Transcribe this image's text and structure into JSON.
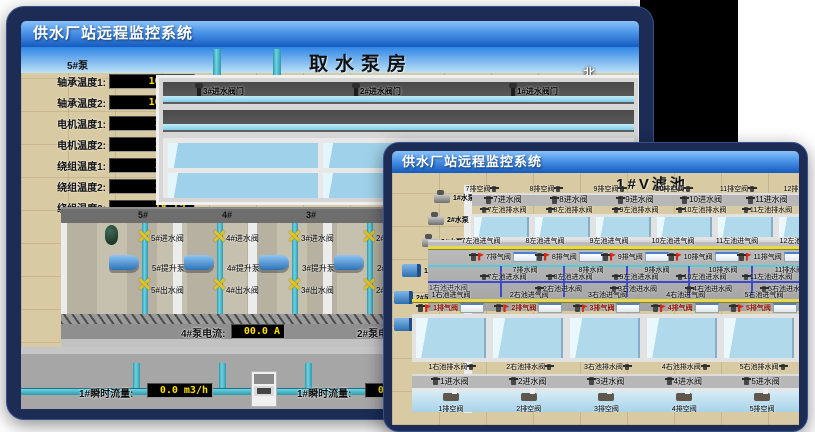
{
  "page": {
    "background": "#ffffff"
  },
  "colors": {
    "window_frame": "#1c2c55",
    "titlebar_top": "#8ac2f9",
    "titlebar_bottom": "#155abe",
    "title_text": "#ffffff",
    "floor_tan": "#d8caa2",
    "sky_blue": "#2f86e6",
    "pool_water": "#b1d9ec",
    "pipe_teal": "#45b9cc",
    "pipe_yellow": "#e6d84a",
    "pipe_blue": "#3c49c8",
    "display_bg": "#000000",
    "display_text": "#ffe000",
    "valve_yellow": "#e0c22a",
    "pump_blue": "#4f9ede",
    "alarm_red": "#d22a14"
  },
  "back_window": {
    "title": "供水厂站远程监控系统",
    "scene_title": "取水泵房",
    "compass": {
      "north": "北",
      "south": "南",
      "east": "东",
      "west": "西"
    },
    "pump_panel": {
      "title": "5#泵",
      "fields": [
        {
          "label": "轴承温度1:",
          "value": "100.0℃"
        },
        {
          "label": "轴承温度2:",
          "value": "100.0℃"
        },
        {
          "label": "电机温度1:",
          "value": "18.1℃"
        },
        {
          "label": "电机温度2:",
          "value": "17.9℃"
        },
        {
          "label": "绕组温度1:",
          "value": "18.0℃"
        },
        {
          "label": "绕组温度2:",
          "value": "18.1℃"
        },
        {
          "label": "绕组温度3:",
          "value": "18.1℃"
        },
        {
          "label": "管道压力:",
          "value": "0.0007MPa"
        },
        {
          "label": "多功能阀:",
          "value": "0%"
        }
      ]
    },
    "right_panel_labels": [
      "轴承温度1:",
      "轴承温度2:"
    ],
    "right_pump_tag": "1#泵",
    "intake_valves": [
      "3#进水阀门",
      "2#进水阀门",
      "1#进水阀门"
    ],
    "pump_bays": [
      {
        "bay": "5#",
        "inlet": "5#进水阀",
        "pump": "5#提升泵",
        "outlet": "5#出水阀"
      },
      {
        "bay": "4#",
        "inlet": "4#进水阀",
        "pump": "4#提升泵",
        "outlet": "4#出水阀"
      },
      {
        "bay": "3#",
        "inlet": "3#进水阀",
        "pump": "3#提升泵",
        "outlet": "3#出水阀"
      },
      {
        "bay": "2#",
        "inlet": "2#进水阀",
        "pump": "2#提升泵",
        "outlet": "2#出水阀"
      }
    ],
    "current_left": {
      "label": "4#泵电流:",
      "value": "00.0 A"
    },
    "current_right": {
      "label": "2#泵电流:"
    },
    "flow_left": {
      "label": "1#瞬时流量:",
      "value": "0.0 m3/h"
    },
    "flow_right": {
      "label": "1#瞬时流量:",
      "value": "0.0 m3/h"
    }
  },
  "front_window": {
    "title": "供水厂站远程监控系统",
    "scene_title": "1#V滤池",
    "water_pumps": [
      "1#水泵",
      "2#水泵",
      "3#水泵"
    ],
    "blowers": [
      "1#风机",
      "2#风机",
      "3#风机"
    ],
    "top_vent_valves": [
      "7排空阀",
      "8排空阀",
      "9排空阀",
      "10排空阀",
      "11排空阀",
      "12排空阀"
    ],
    "top_inlet_valves": [
      "7进水阀",
      "8进水阀",
      "9进水阀",
      "10进水阀",
      "11进水阀"
    ],
    "top_drain_valves": [
      "7左池排水阀",
      "8左池排水阀",
      "9左池排水阀",
      "10左池排水阀",
      "11左池排水阀"
    ],
    "upper_air_valves": [
      "7左池进气阀",
      "8左池进气阀",
      "9左池进气阀",
      "10左池进气阀",
      "11左池进气阀",
      "12左池进气阀"
    ],
    "upper_exhaust_valves": [
      "7排气阀",
      "8排气阀",
      "9排气阀",
      "10排气阀",
      "11排气阀"
    ],
    "upper_drain_valves": [
      "7排水阀",
      "8排水阀",
      "9排水阀",
      "10排水阀",
      "11排水阀"
    ],
    "upper_water_valves": [
      "7左池进水阀",
      "8左池进水阀",
      "9左池进水阀",
      "10左池进水阀",
      "11左池进水阀"
    ],
    "lower_water_valves": [
      "2右池进水阀",
      "3右池进水阀",
      "4右池进水阀",
      "5右池进水阀"
    ],
    "lower_left_water_valve": "1右池进水阀",
    "lower_air_valves": [
      "1右池进气阀",
      "2右池进气阀",
      "3右池进气阀",
      "4右池进气阀",
      "5右池进气阀"
    ],
    "lower_exhaust_valves": [
      "1排气阀",
      "2排气阀",
      "3排气阀",
      "4排气阀",
      "5排气阀"
    ],
    "lower_drain_valves": [
      "1右池排水阀",
      "2右池排水阀",
      "3右池排水阀",
      "4右池排水阀",
      "5右池排水阀"
    ],
    "bottom_inlet_valves": [
      "1进水阀",
      "2进水阀",
      "3进水阀",
      "4进水阀",
      "5进水阀"
    ],
    "bottom_vent_valves": [
      "1排空阀",
      "2排空阀",
      "3排空阀",
      "4排空阀",
      "5排空阀"
    ]
  }
}
